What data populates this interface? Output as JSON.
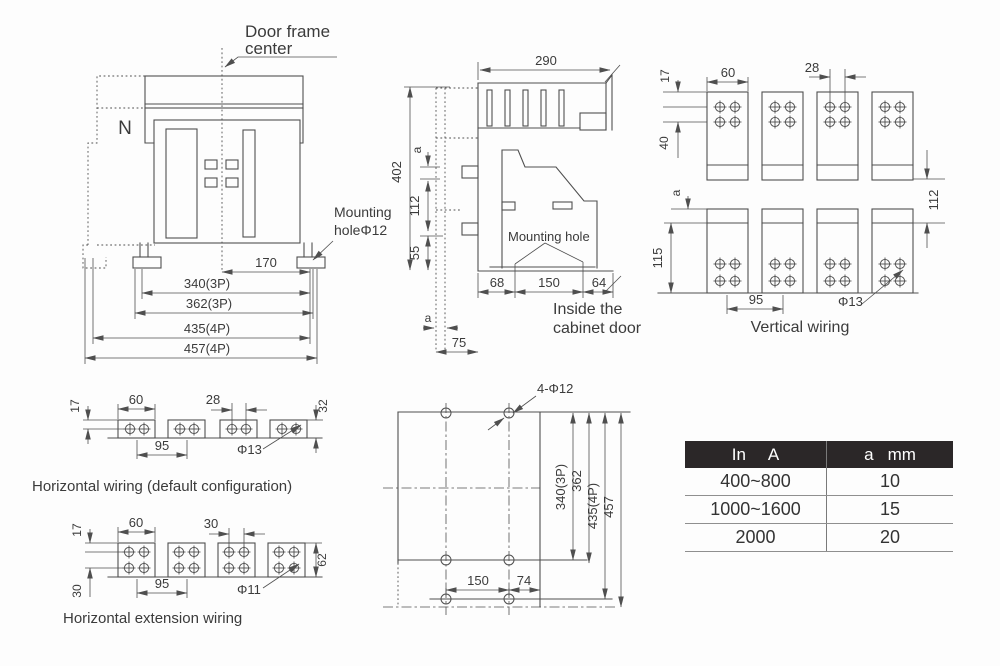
{
  "front_view": {
    "door_frame_label_line1": "Door frame",
    "door_frame_label_line2": "center",
    "neutral_pole_label": "N",
    "mounting_hole_label_line1": "Mounting",
    "mounting_hole_label_line2": "holeΦ12",
    "dim_170": "170",
    "dim_340_3p": "340(3P)",
    "dim_362_3p": "362(3P)",
    "dim_435_4p": "435(4P)",
    "dim_457_4p": "457(4P)"
  },
  "side_view": {
    "dim_290": "290",
    "dim_402": "402",
    "dim_a_upper": "a",
    "dim_112": "112",
    "dim_55": "55",
    "mounting_hole_label": "Mounting hole",
    "dim_68": "68",
    "dim_150": "150",
    "dim_64": "64",
    "inside_label_line1": "Inside the",
    "inside_label_line2": "cabinet door",
    "dim_a_lower": "a",
    "dim_75": "75"
  },
  "vertical_wiring": {
    "caption": "Vertical wiring",
    "dim_17": "17",
    "dim_60": "60",
    "dim_28": "28",
    "dim_40": "40",
    "dim_a": "a",
    "dim_115": "115",
    "dim_112": "112",
    "dim_95": "95",
    "dim_phi13": "Φ13"
  },
  "horizontal_wiring": {
    "caption": "Horizontal wiring (default configuration)",
    "dim_17": "17",
    "dim_60": "60",
    "dim_28": "28",
    "dim_32": "32",
    "dim_95": "95",
    "dim_phi13": "Φ13"
  },
  "horizontal_extension_wiring": {
    "caption": "Horizontal extension wiring",
    "dim_17": "17",
    "dim_60": "60",
    "dim_30_top": "30",
    "dim_30_left": "30",
    "dim_62": "62",
    "dim_95": "95",
    "dim_phi11": "Φ11"
  },
  "drilling_plan": {
    "hole_callout": "4-Φ12",
    "dim_340_3p": "340(3P)",
    "dim_362": "362",
    "dim_435_4p": "435(4P)",
    "dim_457": "457",
    "dim_150": "150",
    "dim_74": "74"
  },
  "selection_table": {
    "header_col1": [
      "In",
      "A"
    ],
    "header_col2": [
      "a",
      "mm"
    ],
    "rows": [
      [
        "400~800",
        "10"
      ],
      [
        "1000~1600",
        "15"
      ],
      [
        "2000",
        "20"
      ]
    ]
  },
  "colors": {
    "line": "#4f4f4f",
    "text": "#3b3b3b",
    "table_header_bg": "#2b2728",
    "table_header_text": "#ffffff"
  }
}
